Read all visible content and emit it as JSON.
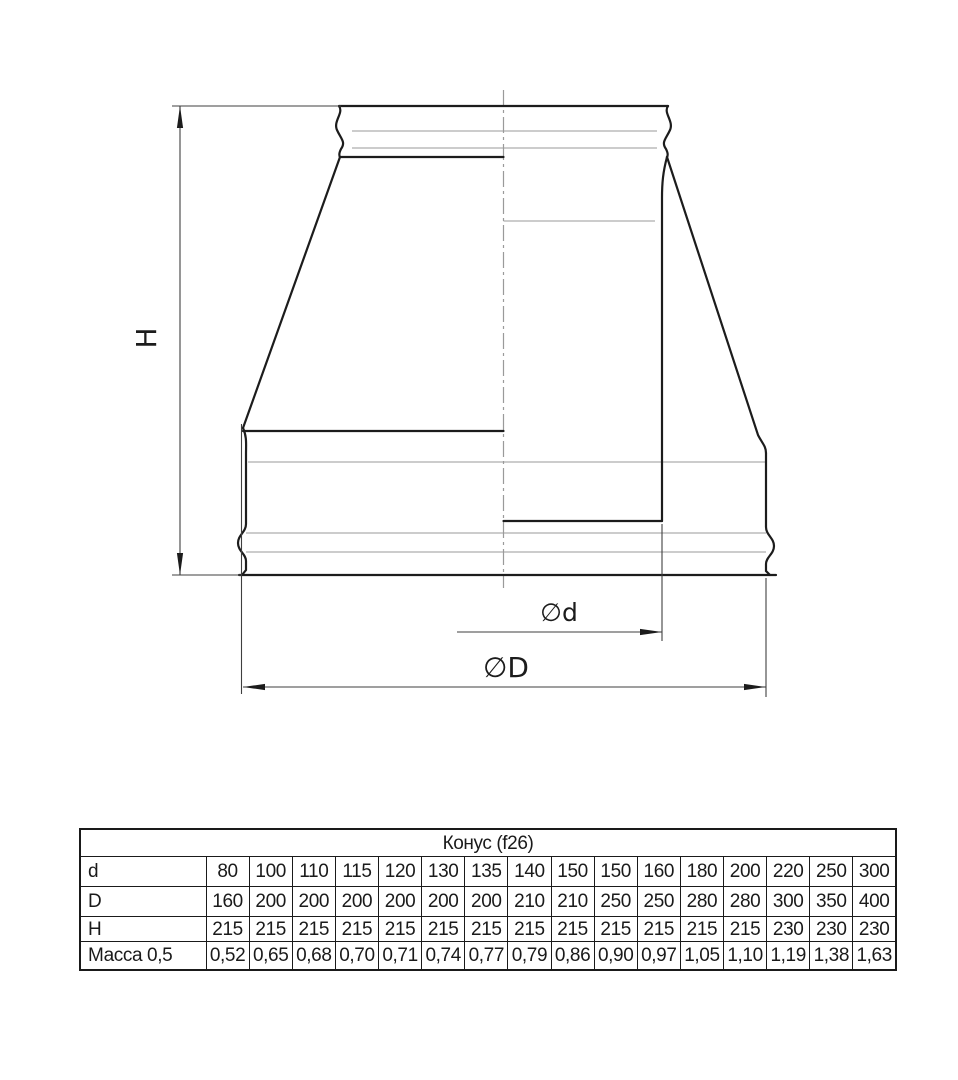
{
  "drawing": {
    "labels": {
      "height": "H",
      "inner_diameter": "∅d",
      "outer_diameter": "∅D"
    },
    "ink_color": "#1c1c1c",
    "thin_line_color": "#999999",
    "dim_line_color": "#3f3f3f"
  },
  "table": {
    "title": "Конус (f26)",
    "rows": [
      {
        "label": "d",
        "values": [
          "80",
          "100",
          "110",
          "115",
          "120",
          "130",
          "135",
          "140",
          "150",
          "150",
          "160",
          "180",
          "200",
          "220",
          "250",
          "300"
        ]
      },
      {
        "label": "D",
        "values": [
          "160",
          "200",
          "200",
          "200",
          "200",
          "200",
          "200",
          "210",
          "210",
          "250",
          "250",
          "280",
          "280",
          "300",
          "350",
          "400"
        ]
      },
      {
        "label": "H",
        "values": [
          "215",
          "215",
          "215",
          "215",
          "215",
          "215",
          "215",
          "215",
          "215",
          "215",
          "215",
          "215",
          "215",
          "230",
          "230",
          "230"
        ]
      },
      {
        "label": "Масса 0,5",
        "values": [
          "0,52",
          "0,65",
          "0,68",
          "0,70",
          "0,71",
          "0,74",
          "0,77",
          "0,79",
          "0,86",
          "0,90",
          "0,97",
          "1,05",
          "1,10",
          "1,19",
          "1,38",
          "1,63"
        ]
      }
    ]
  }
}
